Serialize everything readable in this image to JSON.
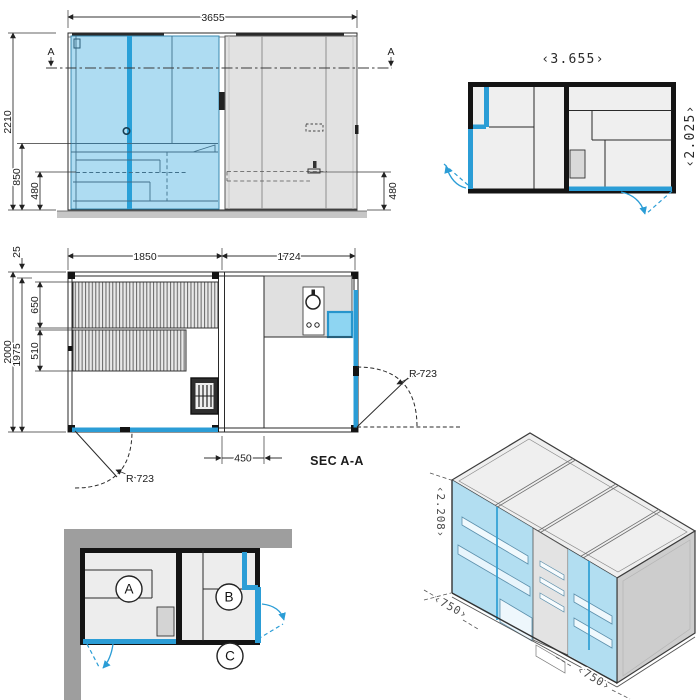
{
  "colors": {
    "accent_blue": "#2b9dd6",
    "glass_blue": "#aedcf2",
    "panel_gray": "#e2e2e2",
    "wall_black": "#141414",
    "building_gray": "#9e9e9e"
  },
  "front_elevation": {
    "total_width": "3655",
    "total_height": "2210",
    "bench_height": "850",
    "step_height_left": "480",
    "step_height_right": "480",
    "section_marker_left": "A",
    "section_marker_right": "A"
  },
  "top_plan": {
    "overall_width": "‹3.655›",
    "overall_depth": "‹2.025›"
  },
  "section_plan": {
    "title": "SEC A-A",
    "sauna_width": "1850",
    "shower_width": "1724",
    "top_offset": "25",
    "outer_depth": "2000",
    "inner_depth": "1975",
    "upper_bench_depth": "650",
    "lower_bench_depth": "510",
    "screen_offset": "450",
    "door_radius_left": "R 723",
    "door_radius_right": "R 723"
  },
  "location_plan": {
    "room_a": "A",
    "room_b": "B",
    "room_c": "C"
  },
  "isometric_view": {
    "height": "‹2.208›",
    "module_left": "‹750›",
    "module_right": "‹750›"
  }
}
